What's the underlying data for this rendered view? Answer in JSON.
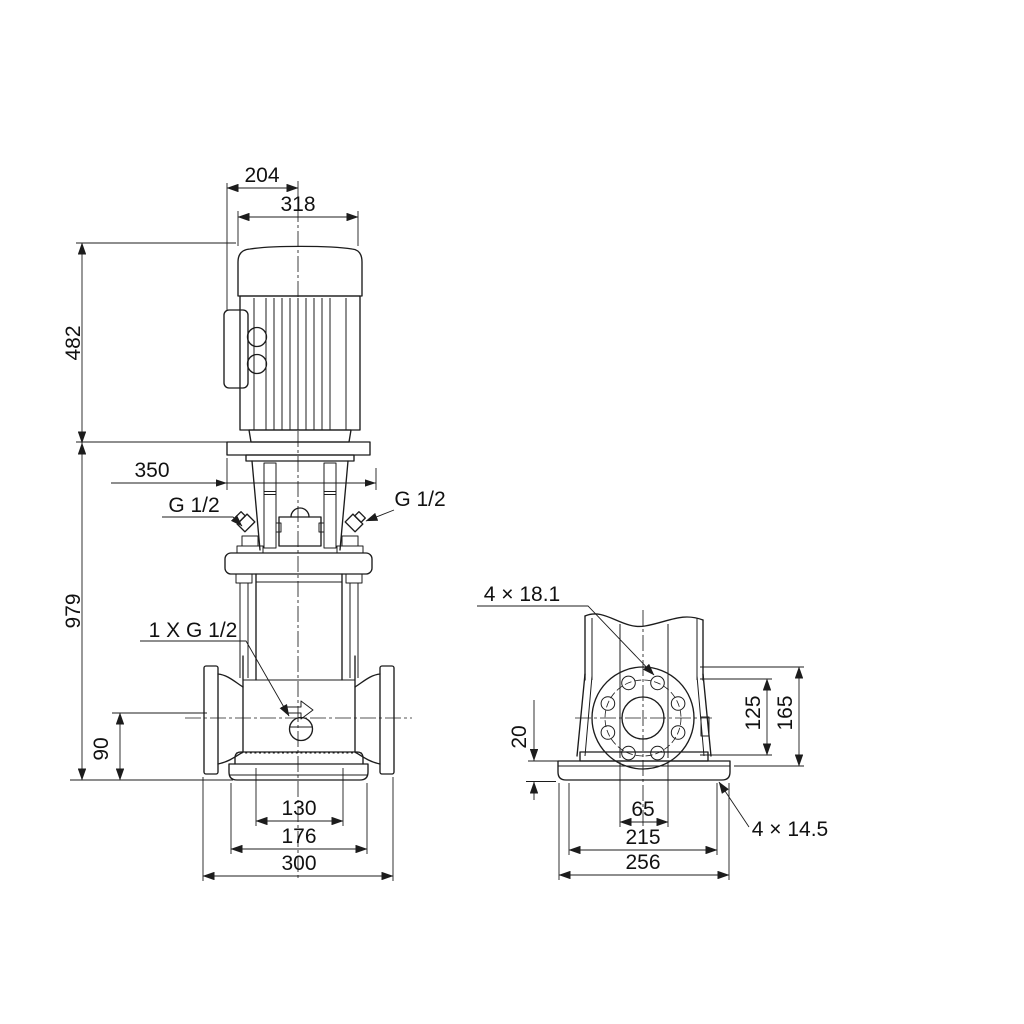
{
  "front_view": {
    "dims": {
      "motor_top_width": "204",
      "motor_width": "318",
      "motor_height": "482",
      "total_height": "979",
      "clearance": "350",
      "port_height": "90",
      "base_inner": "130",
      "base_middle": "176",
      "port_span": "300"
    },
    "labels": {
      "gauge_port_left": "G 1/2",
      "gauge_port_right": "G 1/2",
      "drain_port": "1 X G 1/2"
    }
  },
  "side_view": {
    "dims": {
      "plate_thickness": "20",
      "bolt_circle_height": "125",
      "flange_top_height": "165",
      "anchor_inner": "65",
      "anchor_span": "215",
      "base_depth": "256"
    },
    "labels": {
      "flange_holes": "4 × 18.1",
      "foot_holes": "4 × 14.5"
    }
  }
}
